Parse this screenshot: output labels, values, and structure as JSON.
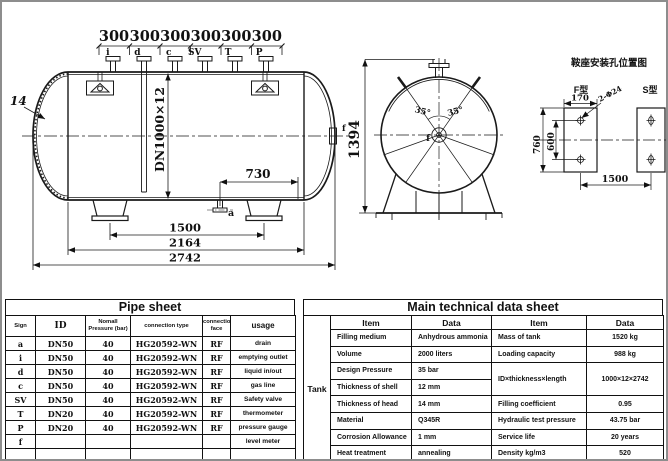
{
  "drawing": {
    "side_view": {
      "spacing_labels": [
        "300",
        "300",
        "300",
        "300",
        "300",
        "300"
      ],
      "nozzles_top": [
        "i",
        "d",
        "c",
        "SV",
        "T",
        "P"
      ],
      "head_thickness": "14",
      "shell_spec": "DN1000×12",
      "dim_drain_offset": "730",
      "nozzle_bottom": "a",
      "nozzle_right": "f",
      "dim_saddle_spacing": "1500",
      "dim_tangent_length": "2164",
      "dim_overall_length": "2742"
    },
    "end_view": {
      "dim_overall_height": "1394",
      "angle_labels": [
        "35°",
        "35°"
      ],
      "center_label": "f"
    },
    "saddle_diagram": {
      "title": "鞍座安装孔位置图",
      "f_type": "F型",
      "s_type": "S型",
      "dim_width": "170",
      "holes_label": "2-Φ24",
      "dim_height": "760",
      "dim_hole_spacing": "600",
      "dim_saddle_distance": "1500"
    }
  },
  "pipe_sheet": {
    "title": "Pipe sheet",
    "headers": [
      "Sign",
      "ID",
      "Nomall Pressure (bar)",
      "connection type",
      "connection face",
      "usage"
    ],
    "rows": [
      [
        "a",
        "DN50",
        "40",
        "HG20592-WN",
        "RF",
        "drain"
      ],
      [
        "i",
        "DN50",
        "40",
        "HG20592-WN",
        "RF",
        "emptying outlet"
      ],
      [
        "d",
        "DN50",
        "40",
        "HG20592-WN",
        "RF",
        "liquid in/out"
      ],
      [
        "c",
        "DN50",
        "40",
        "HG20592-WN",
        "RF",
        "gas line"
      ],
      [
        "SV",
        "DN50",
        "40",
        "HG20592-WN",
        "RF",
        "Safety valve"
      ],
      [
        "T",
        "DN20",
        "40",
        "HG20592-WN",
        "RF",
        "thermometer"
      ],
      [
        "P",
        "DN20",
        "40",
        "HG20592-WN",
        "RF",
        "pressure gauge"
      ],
      [
        "f",
        "",
        "",
        "",
        "",
        "level meter"
      ],
      [
        "",
        "",
        "",
        "",
        "",
        ""
      ]
    ]
  },
  "main_sheet": {
    "title": "Main technical data sheet",
    "group_label": "Tank",
    "headers": [
      "Item",
      "Data",
      "Item",
      "Data"
    ],
    "left_rows": [
      [
        "Filling medium",
        "Anhydrous ammonia"
      ],
      [
        "Volume",
        "2000 liters"
      ],
      [
        "Design Pressure",
        "35 bar"
      ],
      [
        "Thickness of shell",
        "12 mm"
      ],
      [
        "Thickness of head",
        "14 mm"
      ],
      [
        "Material",
        "Q345R"
      ],
      [
        "Corrosion Allowance",
        "1 mm"
      ],
      [
        "Heat treatment",
        "annealing"
      ]
    ],
    "right_rows": [
      [
        "Mass of tank",
        "1520 kg"
      ],
      [
        "Loading capacity",
        "988 kg"
      ],
      [
        "ID×thickness×length",
        "1000×12×2742"
      ],
      [
        "Filling coefficient",
        "0.95"
      ],
      [
        "Hydraulic test pressure",
        "43.75 bar"
      ],
      [
        "Service life",
        "20 years"
      ],
      [
        "Density kg/m3",
        "520"
      ]
    ]
  }
}
